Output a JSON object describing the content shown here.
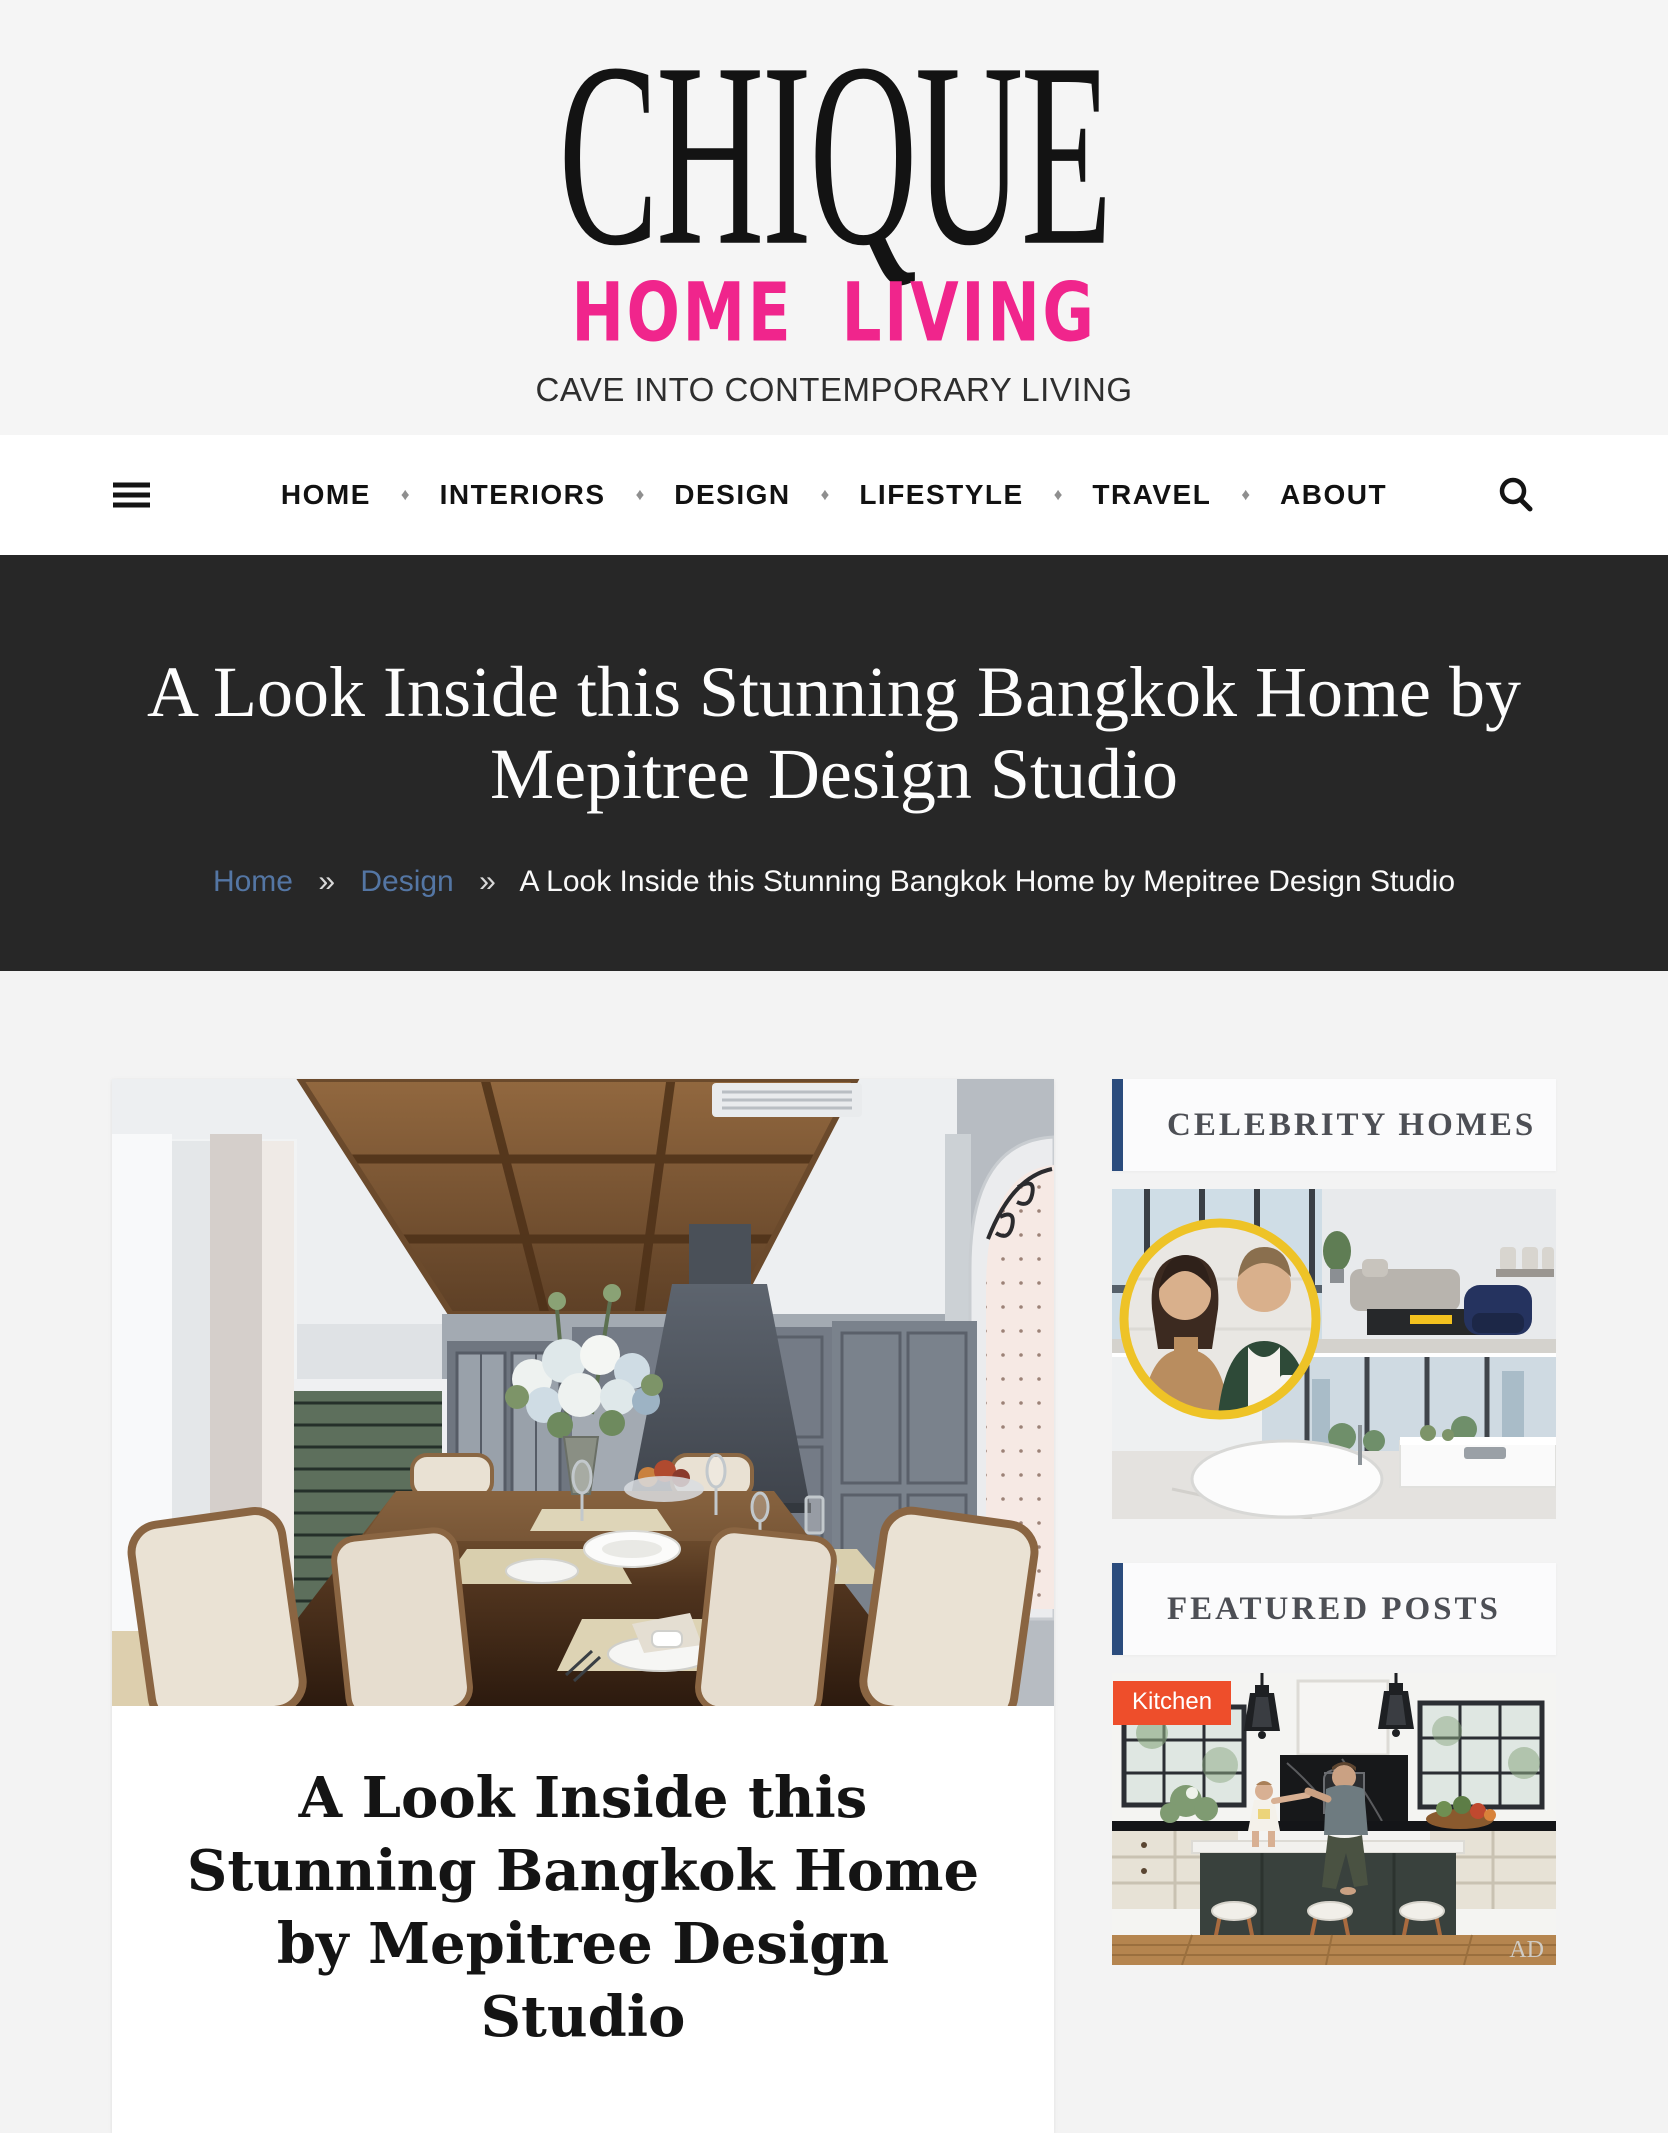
{
  "colors": {
    "accent-pink": "#f0258c",
    "link-blue": "#5476a4",
    "widget-accent": "#2b4c7d",
    "badge-orange": "#ee4e2b",
    "hero-bg": "#272727"
  },
  "header": {
    "logo_title": "CHIQUE",
    "logo_subtitle": "HOME LIVING",
    "tagline": "CAVE INTO CONTEMPORARY LIVING"
  },
  "nav": {
    "items": [
      "HOME",
      "INTERIORS",
      "DESIGN",
      "LIFESTYLE",
      "TRAVEL",
      "ABOUT"
    ],
    "separator": "♦"
  },
  "hero": {
    "title": "A Look Inside this Stunning Bangkok Home by Mepitree Design Studio",
    "breadcrumb": {
      "home": "Home",
      "section": "Design",
      "separator": "»",
      "current": "A Look Inside this Stunning Bangkok Home by Mepitree Design Studio"
    }
  },
  "article": {
    "title": "A Look Inside this Stunning Bangkok Home by Mepitree Design Studio"
  },
  "sidebar": {
    "celebrity_widget": {
      "title": "CELEBRITY HOMES"
    },
    "featured_widget": {
      "title": "FEATURED POSTS",
      "badge": "Kitchen",
      "watermark": "AD"
    }
  }
}
